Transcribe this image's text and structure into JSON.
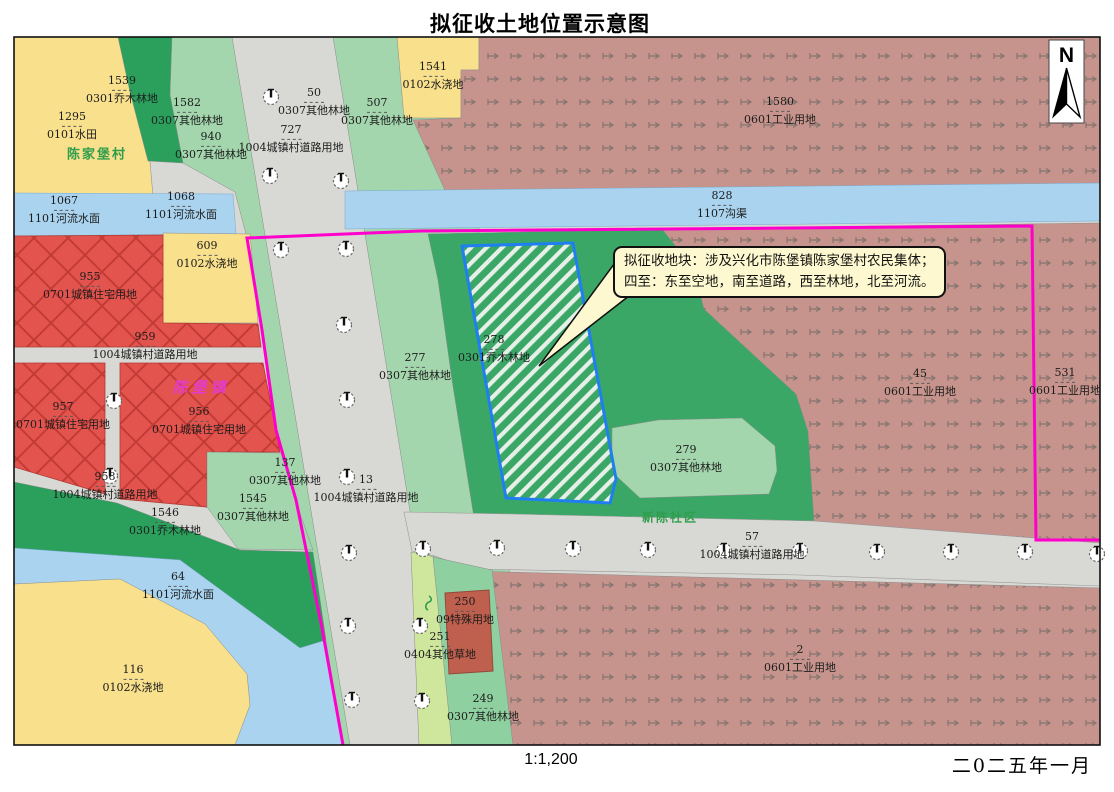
{
  "title": "拟征收土地位置示意图",
  "scale_label": "1:1,200",
  "date_label": "二0二五年一月",
  "north_label": "N",
  "callout": {
    "line1": "拟征收地块：涉及兴化市陈堡镇陈家堡村农民集体；",
    "line2": "四至：东至空地，南至道路，西至林地，北至河流。"
  },
  "palette": {
    "road_gray": "#d8d8d4",
    "water_blue": "#a9d3ee",
    "field_yellow": "#f8e08d",
    "forest_dark": "#2aa05c",
    "forest_mid": "#3aa767",
    "forest_light": "#a4d6ad",
    "grass_light": "#cfe79c",
    "residential_red": "#e4544e",
    "residential_hatch": "#c23b34",
    "industrial_brown": "#c6948c",
    "industrial_glyph": "#857470",
    "special_red": "#bf5f4d",
    "boundary_magenta": "#ff00cc",
    "parcel_blue": "#1f7ff0",
    "callout_bg": "#fdf8cf",
    "hatch_stripe": "#e6efe8"
  },
  "map": {
    "area_names": [
      {
        "text": "陈家堡村",
        "x": 97,
        "y": 153,
        "cls": "village"
      },
      {
        "text": "陈堡镇",
        "x": 201,
        "y": 387,
        "cls": "town"
      },
      {
        "text": "新陈社区",
        "x": 670,
        "y": 517,
        "cls": "community"
      }
    ],
    "parcel_labels": [
      {
        "num": "1539",
        "use": "0301乔木林地",
        "x": 122,
        "y": 90
      },
      {
        "num": "1295",
        "use": "0101水田",
        "x": 72,
        "y": 126
      },
      {
        "num": "1582",
        "use": "0307其他林地",
        "x": 187,
        "y": 112
      },
      {
        "num": "940",
        "use": "0307其他林地",
        "x": 211,
        "y": 146
      },
      {
        "num": "50",
        "use": "0307其他林地",
        "x": 314,
        "y": 102
      },
      {
        "num": "727",
        "use": "1004城镇村道路用地",
        "x": 291,
        "y": 139
      },
      {
        "num": "507",
        "use": "0307其他林地",
        "x": 377,
        "y": 112
      },
      {
        "num": "1541",
        "use": "0102水浇地",
        "x": 433,
        "y": 76
      },
      {
        "num": "1580",
        "use": "0601工业用地",
        "x": 780,
        "y": 111
      },
      {
        "num": "1067",
        "use": "1101河流水面",
        "x": 64,
        "y": 210
      },
      {
        "num": "1068",
        "use": "1101河流水面",
        "x": 181,
        "y": 206
      },
      {
        "num": "828",
        "use": "1107沟渠",
        "x": 722,
        "y": 205
      },
      {
        "num": "609",
        "use": "0102水浇地",
        "x": 207,
        "y": 255
      },
      {
        "num": "955",
        "use": "0701城镇住宅用地",
        "x": 90,
        "y": 286
      },
      {
        "num": "959",
        "use": "1004城镇村道路用地",
        "x": 145,
        "y": 346
      },
      {
        "num": "957",
        "use": "0701城镇住宅用地",
        "x": 63,
        "y": 416
      },
      {
        "num": "956",
        "use": "0701城镇住宅用地",
        "x": 199,
        "y": 421
      },
      {
        "num": "958",
        "use": "1004城镇村道路用地",
        "x": 105,
        "y": 486
      },
      {
        "num": "1546",
        "use": "0301乔木林地",
        "x": 165,
        "y": 522
      },
      {
        "num": "137",
        "use": "0307其他林地",
        "x": 285,
        "y": 472
      },
      {
        "num": "1545",
        "use": "0307其他林地",
        "x": 253,
        "y": 508
      },
      {
        "num": "64",
        "use": "1101河流水面",
        "x": 178,
        "y": 586
      },
      {
        "num": "116",
        "use": "0102水浇地",
        "x": 133,
        "y": 679
      },
      {
        "num": "277",
        "use": "0307其他林地",
        "x": 415,
        "y": 367
      },
      {
        "num": "13",
        "use": "1004城镇村道路用地",
        "x": 366,
        "y": 489
      },
      {
        "num": "278",
        "use": "0301乔木林地",
        "x": 494,
        "y": 349
      },
      {
        "num": "279",
        "use": "0307其他林地",
        "x": 686,
        "y": 459
      },
      {
        "num": "57",
        "use": "1004城镇村道路用地",
        "x": 752,
        "y": 546
      },
      {
        "num": "45",
        "use": "0601工业用地",
        "x": 920,
        "y": 383
      },
      {
        "num": "531",
        "use": "0601工业用地",
        "x": 1065,
        "y": 382
      },
      {
        "num": "2",
        "use": "0601工业用地",
        "x": 800,
        "y": 659
      },
      {
        "num": "250",
        "use": "09特殊用地",
        "x": 465,
        "y": 611
      },
      {
        "num": "251",
        "use": "0404其他草地",
        "x": 440,
        "y": 646
      },
      {
        "num": "249",
        "use": "0307其他林地",
        "x": 483,
        "y": 708
      }
    ],
    "lamps": [
      [
        271,
        97
      ],
      [
        270,
        176
      ],
      [
        341,
        181
      ],
      [
        281,
        250
      ],
      [
        346,
        249
      ],
      [
        344,
        325
      ],
      [
        347,
        400
      ],
      [
        347,
        477
      ],
      [
        349,
        553
      ],
      [
        348,
        626
      ],
      [
        352,
        700
      ],
      [
        423,
        549
      ],
      [
        420,
        626
      ],
      [
        422,
        701
      ],
      [
        497,
        548
      ],
      [
        573,
        549
      ],
      [
        648,
        550
      ],
      [
        724,
        551
      ],
      [
        800,
        551
      ],
      [
        877,
        552
      ],
      [
        951,
        552
      ],
      [
        1025,
        552
      ],
      [
        1097,
        554
      ],
      [
        114,
        401
      ],
      [
        110,
        476
      ]
    ]
  }
}
